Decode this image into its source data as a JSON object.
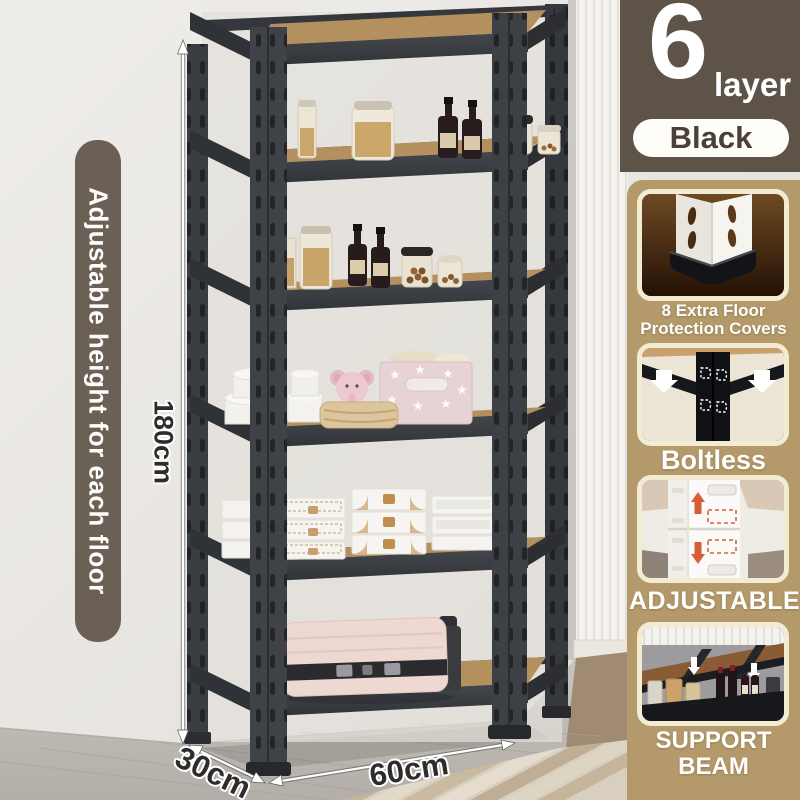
{
  "product": {
    "layers_badge": {
      "count": "6",
      "unit": "layer"
    },
    "color_badge": "Black",
    "banner": "Adjustable height for each floor",
    "dimensions": {
      "height": "180cm",
      "depth": "30cm",
      "width": "60cm"
    }
  },
  "features": [
    {
      "caption": "8 Extra Floor Protection Covers",
      "icon": "floor-protection-corner"
    },
    {
      "caption": "Boltless",
      "icon": "boltless-post"
    },
    {
      "caption": "ADJUSTABLE",
      "icon": "adjustable-slots"
    },
    {
      "caption": "SUPPORT BEAM",
      "icon": "support-beam-underside"
    }
  ],
  "colors": {
    "banner_brown": "#6b6055",
    "badge_brown": "#5e5349",
    "sidebar_tan": "#b49a6b",
    "card_border_cream": "#f3ebd2",
    "pill_text_brown": "#4a4038",
    "shelf_metal": "#3b3e42",
    "shelf_wood": "#b5905f",
    "accent_red_arrow": "#d85e38"
  }
}
